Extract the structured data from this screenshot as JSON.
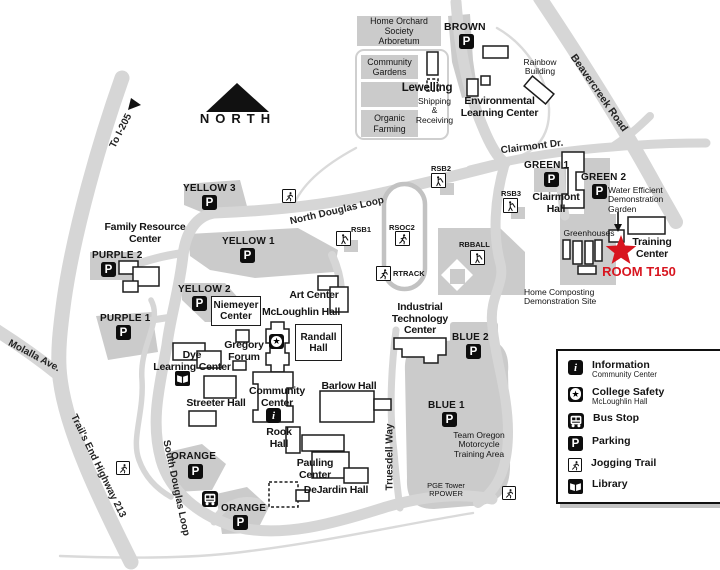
{
  "colors": {
    "road": "#d6d6d6",
    "lot": "#cbcbcb",
    "trail": "#dadada",
    "ink": "#141414",
    "accent": "#d8151f"
  },
  "compass": {
    "north": "NORTH",
    "to_i205": "To I-205"
  },
  "roads": {
    "beavercreek": "Beavercreek Road",
    "clairmont": "Clairmont Dr.",
    "north_douglas": "North Douglas Loop",
    "south_douglas": "South Douglas Loop",
    "truesdell": "Truesdell Way",
    "molalla": "Molalla Ave.",
    "trails_end": "Trail's End Highway 213"
  },
  "sites": {
    "home_orchard": "Home Orchard Society\nArboretum",
    "community_gardens": "Community\nGardens",
    "organic_farming": "Organic\nFarming",
    "lewelling": "Lewelling",
    "shipping": "Shipping\n&\nReceiving",
    "environmental": "Environmental\nLearning Center",
    "rainbow": "Rainbow\nBuilding",
    "water_garden": "Water Efficient\nDemonstration\nGarden",
    "greenhouses": "Greenhouses",
    "training_center": "Training\nCenter",
    "room_t150": "ROOM T150",
    "home_composting": "Home Composting\nDemonstration Site",
    "team_oregon": "Team Oregon\nMotorcycle\nTraining Area",
    "pge_tower": "PGE Tower\nRPOWER"
  },
  "buildings": {
    "clairmont_hall": "Clairmont\nHall",
    "family_resource": "Family Resource\nCenter",
    "niemeyer": "Niemeyer\nCenter",
    "mcloughlin": "McLoughlin Hall",
    "art_center": "Art Center",
    "gregory": "Gregory\nForum",
    "randall": "Randall\nHall",
    "dye": "Dye\nLearning Center",
    "streeter": "Streeter Hall",
    "community_center": "Community\nCenter",
    "rook": "Rook\nHall",
    "barlow": "Barlow Hall",
    "pauling": "Pauling\nCenter",
    "dejardin": "DeJardin Hall",
    "industrial": "Industrial\nTechnology\nCenter"
  },
  "parking": {
    "yellow3": "YELLOW 3",
    "yellow1": "YELLOW 1",
    "yellow2": "YELLOW 2",
    "purple2": "PURPLE 2",
    "purple1": "PURPLE 1",
    "brown": "BROWN",
    "green1": "GREEN 1",
    "green2": "GREEN 2",
    "blue2": "BLUE 2",
    "blue1": "BLUE 1",
    "orange_south": "ORANGE",
    "orange_east": "ORANGE"
  },
  "sports": {
    "rsb1": "RSB1",
    "rsb2": "RSB2",
    "rsb3": "RSB3",
    "rsoc2": "RSOC2",
    "rtrack": "RTRACK",
    "rbball": "RBBALL"
  },
  "icons": {
    "parking": "P",
    "information": "i",
    "safety_star": "★"
  },
  "legend": {
    "items": [
      {
        "icon": "information-icon",
        "label": "Information",
        "sublabel": "Community Center"
      },
      {
        "icon": "college-safety-icon",
        "label": "College Safety",
        "sublabel": "McLoughlin Hall"
      },
      {
        "icon": "bus-stop-icon",
        "label": "Bus Stop",
        "sublabel": ""
      },
      {
        "icon": "parking-icon",
        "label": "Parking",
        "sublabel": ""
      },
      {
        "icon": "jogging-trail-icon",
        "label": "Jogging Trail",
        "sublabel": ""
      },
      {
        "icon": "library-icon",
        "label": "Library",
        "sublabel": ""
      }
    ]
  }
}
